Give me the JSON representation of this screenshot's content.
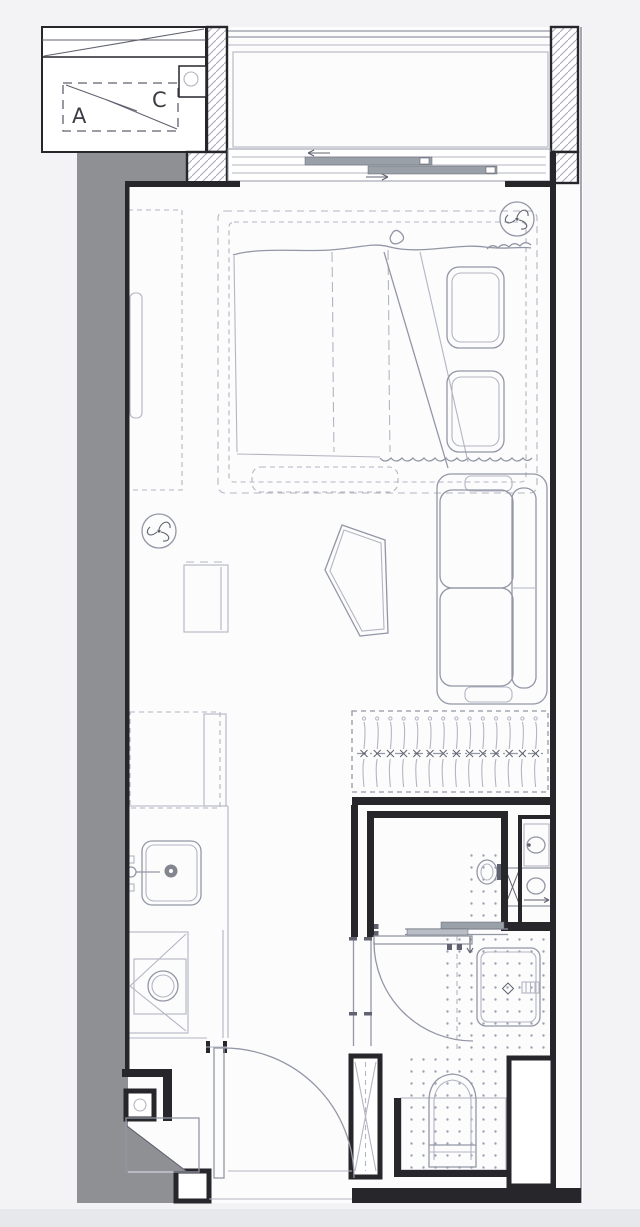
{
  "palette": {
    "bg": "#f3f3f5",
    "paper": "#fcfcfd",
    "wall": "#26262b",
    "line": "#b3b5c2",
    "lineMid": "#9396a5",
    "lineDark": "#60626f",
    "poche": "#8f9094",
    "hatch": "#a6a8b4",
    "panel": "#9aa0a8",
    "dot": "#9da0b0",
    "text": "#3c3c46",
    "drain": "#83858f",
    "pageStrip": "#e7e8eb"
  },
  "labels": {
    "ac_a": "A",
    "ac_c": "C"
  },
  "plan": {
    "type": "floor-plan",
    "rooms": [
      {
        "name": "ac-platform"
      },
      {
        "name": "balcony"
      },
      {
        "name": "living-sleeping-area"
      },
      {
        "name": "kitchenette"
      },
      {
        "name": "entry-hall"
      },
      {
        "name": "vanity-laundry-room"
      },
      {
        "name": "shower-toilet-room"
      },
      {
        "name": "duct-shaft"
      }
    ],
    "furniture": [
      {
        "name": "wardrobe"
      },
      {
        "name": "double-bed"
      },
      {
        "name": "pillow",
        "count": 2
      },
      {
        "name": "bed-bench"
      },
      {
        "name": "side-cabinet"
      },
      {
        "name": "coffee-table"
      },
      {
        "name": "sofa"
      },
      {
        "name": "clothes-rail"
      },
      {
        "name": "refrigerator"
      },
      {
        "name": "kitchen-sink"
      },
      {
        "name": "cooktop"
      },
      {
        "name": "shoe-cabinet"
      },
      {
        "name": "washing-machine"
      },
      {
        "name": "vanity-basin"
      },
      {
        "name": "toilet"
      },
      {
        "name": "shower-tray"
      }
    ],
    "symbols": [
      {
        "name": "ceiling-fan-symbol",
        "count": 2
      },
      {
        "name": "door-swing-arc",
        "count": 2
      },
      {
        "name": "sliding-door-symbol",
        "count": 2
      },
      {
        "name": "duct-cross-symbol",
        "count": 2
      },
      {
        "name": "floor-drain-symbol",
        "count": 1
      },
      {
        "name": "tile-dot-pattern"
      },
      {
        "name": "wall-hatch-pattern"
      }
    ]
  },
  "closet": {
    "hanger_count": 14
  }
}
